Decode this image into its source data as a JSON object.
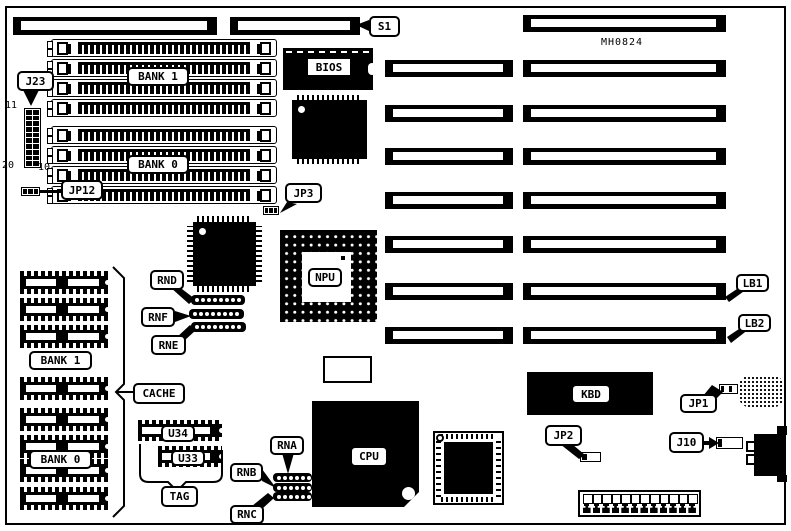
{
  "board_code": "MH0824",
  "colors": {
    "ink": "#000000",
    "paper": "#ffffff"
  },
  "labels": {
    "s1": "S1",
    "j23": "J23",
    "jp12": "JP12",
    "jp3": "JP3",
    "bios": "BIOS",
    "npu": "NPU",
    "cpu": "CPU",
    "kbd": "KBD",
    "cache": "CACHE",
    "tag": "TAG",
    "u34": "U34",
    "u33": "U33",
    "rnd": "RND",
    "rnf": "RNF",
    "rne": "RNE",
    "rna": "RNA",
    "rnb": "RNB",
    "rnc": "RNC",
    "jp2": "JP2",
    "jp1": "JP1",
    "j10": "J10",
    "lb1": "LB1",
    "lb2": "LB2",
    "bank1_simm": "BANK 1",
    "bank0_simm": "BANK 0",
    "bank1_cache": "BANK 1",
    "bank0_cache": "BANK 0"
  },
  "j23_pin_numbers": {
    "top_left": "11",
    "bottom_left": "20",
    "bottom_right": "10"
  }
}
